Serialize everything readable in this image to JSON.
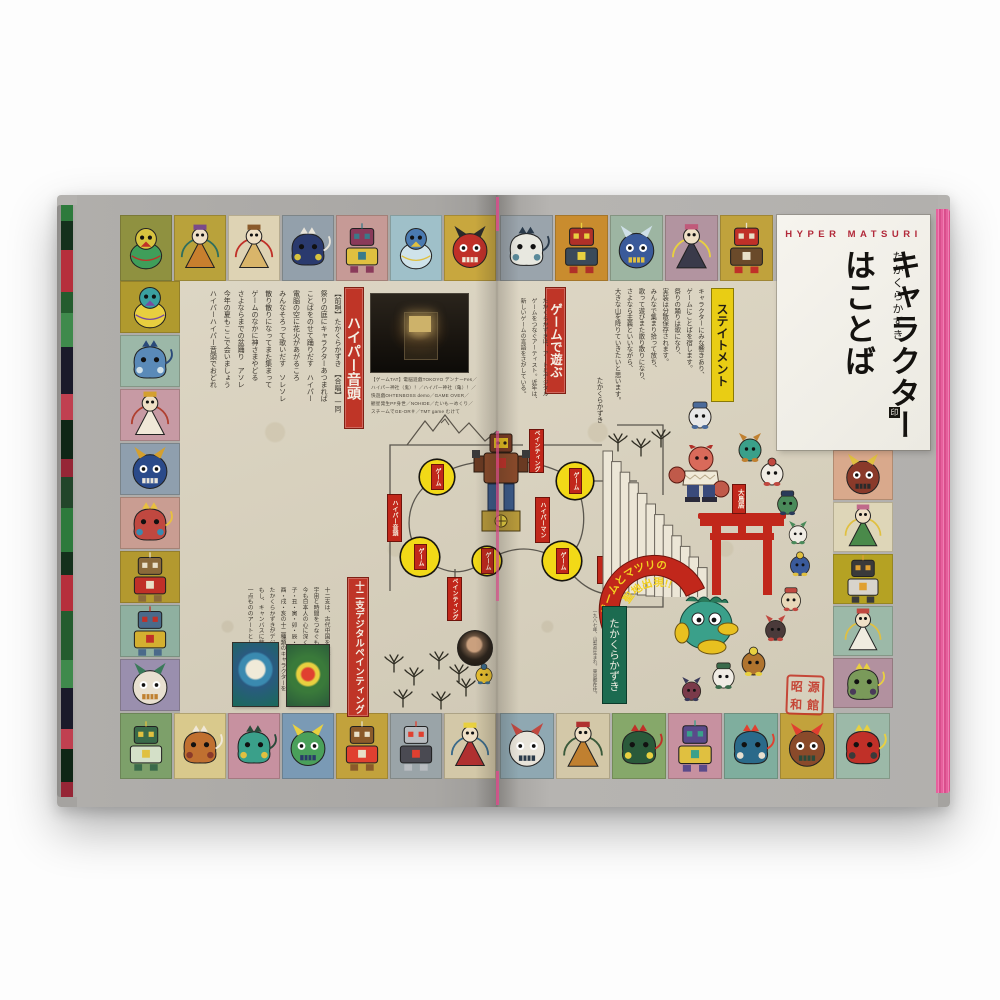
{
  "panel": {
    "kicker": "HYPER MATSURI",
    "author": "たかくらかずき",
    "title": "キャラクターはことば",
    "author_mark": "印"
  },
  "banners": {
    "hyper_ondo": "ハイパー音頭",
    "zodiac": "十二支デジタルペインティング",
    "game_asobi": "ゲームで遊ぶ",
    "statement": "ステイトメント",
    "torii_tag": "大鳥居",
    "arc_line1": "ゲームとマツリの",
    "arc_line2": "聖地出現!!",
    "author_box": "たかくらかずき"
  },
  "statement": {
    "columns": [
      "キャラクターにみな響きあり、",
      "ゲームにことばを宿します。",
      "祭りの踊りは歌になり、",
      "実装は分散保存されます。",
      "みんなで集まり拾って放ち、",
      "歌って遊びまた散り散りになり、",
      "さよなら主義といいながら、",
      "大きな山を降りていきたいと思います。"
    ],
    "signature": "たかくらかずき"
  },
  "lyrics": {
    "columns": [
      "【前唄】たかくらかずき　【合唱】一同",
      "祭りの庭にキャラクターあつまれば",
      "ことばをのせて踊りだす　ハイパー",
      "電脳の空に花火があがるころ",
      "みんなそろって歌いだす　ソレソレ",
      "散り散りになってまた集まって",
      "ゲームのなかに神さまやどる",
      "さよならまでの盆踊り　アソレ",
      "今年の夏もここで会いましょう",
      "ハイパーハイパー音頭でおどれ"
    ]
  },
  "zodiac_text": {
    "columns": [
      "十二支は、古代中国を発祥とするもので、",
      "宇宙と時間をつなぐものとして、",
      "今も日本人の心に深く根ざしています。",
      "子・丑・寅・卯・辰・巳・午・未・申・",
      "酉・戌・亥の十二種類のキャラクターを",
      "たかくらかずきがデジタルで描きます。",
      "もし、キャンバスに飾るとしたら、",
      "一点もののアートとして仕上げました。"
    ]
  },
  "intro_text": {
    "columns": [
      "たかくらかずきは、アートとデジタル",
      "ゲームをつなぐアーティスト。近年は、",
      "新しいゲームの言語をさがしている。"
    ]
  },
  "photo_caption": {
    "lines": [
      "【ゲームTAT】電脳遊戯TOKOYO デンナーFes／",
      "ハイパー神社（鬼）！／ハイパー神社（亀）！／",
      "快遊戯OHTENBOSS demo／GAME OVER／",
      "観星発生PF身世／NOHIDE／たいもーめくり／",
      "スチームでGE-OR＃／TMT game むけて"
    ]
  },
  "profile": "一九八七年、山梨県生まれ。東京都在住。",
  "seal": {
    "chars": [
      "昭",
      "和",
      "源",
      "館"
    ]
  },
  "board": {
    "node_label": "ゲーム",
    "nodes": [
      {
        "x": 380,
        "y": 282,
        "r": 17
      },
      {
        "x": 518,
        "y": 286,
        "r": 18
      },
      {
        "x": 363,
        "y": 362,
        "r": 19
      },
      {
        "x": 430,
        "y": 366,
        "r": 14
      },
      {
        "x": 505,
        "y": 366,
        "r": 19
      }
    ],
    "tags": [
      {
        "text": "ペインティング",
        "x": 473,
        "y": 235,
        "h": 42
      },
      {
        "text": "ハイパーマン",
        "x": 479,
        "y": 303,
        "h": 44
      },
      {
        "text": "ハイパー音頭",
        "x": 331,
        "y": 300,
        "h": 46
      },
      {
        "text": "ペインティング",
        "x": 391,
        "y": 383,
        "h": 42
      },
      {
        "text": "ゲーム",
        "x": 541,
        "y": 362,
        "h": 26
      }
    ]
  },
  "border_tiles": {
    "top_left": [
      {
        "bg": "#8f9140",
        "c1": "#3f9e5a",
        "c2": "#d7c33f",
        "c3": "#c03028",
        "type": "bird",
        "name": "green-parrot"
      },
      {
        "bg": "#b9a23b",
        "c1": "#c87f2e",
        "c2": "#7a4a8a",
        "c3": "#2e6e5e",
        "type": "deity",
        "name": "lotus-deity"
      },
      {
        "bg": "#ded3b4",
        "c1": "#d9b56a",
        "c2": "#8a5a2a",
        "c3": "#c03028",
        "type": "deity",
        "name": "fox-priest"
      },
      {
        "bg": "#93a0ab",
        "c1": "#2a3a6e",
        "c2": "#d7c33f",
        "c3": "#e8e4da",
        "type": "beast",
        "name": "tiger-ghost"
      },
      {
        "bg": "#c69a96",
        "c1": "#8a3a5a",
        "c2": "#e0c040",
        "c3": "#3a7a8a",
        "type": "robot",
        "name": "drummer-robot"
      },
      {
        "bg": "#9fc0c9",
        "c1": "#cfe3ea",
        "c2": "#4a7ab0",
        "c3": "#e0c040",
        "type": "bird",
        "name": "winged-angel"
      },
      {
        "bg": "#c8a73e",
        "c1": "#c03028",
        "c2": "#2a2a2a",
        "c3": "#f0e8d8",
        "type": "oni",
        "name": "red-oni"
      }
    ],
    "left": [
      {
        "bg": "#b09a2e",
        "c1": "#e8cf3f",
        "c2": "#3aa0a0",
        "c3": "#7a4aa0",
        "type": "bird",
        "name": "duck-spirit"
      },
      {
        "bg": "#9cb8a8",
        "c1": "#5a8ab8",
        "c2": "#cfe0e8",
        "c3": "#2a4a7a",
        "type": "beast",
        "name": "cloud-beast"
      },
      {
        "bg": "#c79aa4",
        "c1": "#f0e8d8",
        "c2": "#d4a030",
        "c3": "#b04030",
        "type": "deity",
        "name": "lotus-guardian"
      },
      {
        "bg": "#8f9fae",
        "c1": "#2a4a8a",
        "c2": "#d4a030",
        "c3": "#e8e4da",
        "type": "oni",
        "name": "blue-demon"
      },
      {
        "bg": "#c99d92",
        "c1": "#c04840",
        "c2": "#3a8ab0",
        "c3": "#e8c040",
        "type": "beast",
        "name": "octopus-spirit"
      },
      {
        "bg": "#b3992f",
        "c1": "#8a6a3a",
        "c2": "#c03028",
        "c3": "#e8e0c8",
        "type": "robot",
        "name": "ox-machine"
      },
      {
        "bg": "#8fb0a0",
        "c1": "#4a6a8a",
        "c2": "#d4b030",
        "c3": "#c03028",
        "type": "robot",
        "name": "teal-mecha"
      },
      {
        "bg": "#9a8fae",
        "c1": "#e8e0d0",
        "c2": "#3a7a5a",
        "c3": "#c08030",
        "type": "oni",
        "name": "envelope-cat"
      }
    ],
    "bottom_left": [
      {
        "bg": "#7da06a",
        "c1": "#3a6a4a",
        "c2": "#d4e0c8",
        "c3": "#e0c040",
        "type": "robot",
        "name": "grid-golem"
      },
      {
        "bg": "#d9c98c",
        "c1": "#c07030",
        "c2": "#8a3a2a",
        "c3": "#f0e8d8",
        "type": "beast",
        "name": "orange-crab"
      },
      {
        "bg": "#c791a0",
        "c1": "#3aa08a",
        "c2": "#e0c040",
        "c3": "#2a4a3a",
        "type": "beast",
        "name": "teal-dragon"
      },
      {
        "bg": "#7a9ab5",
        "c1": "#4aa05a",
        "c2": "#e8d040",
        "c3": "#2a3a6a",
        "type": "oni",
        "name": "frog-king"
      },
      {
        "bg": "#c2a23c",
        "c1": "#8a5a2a",
        "c2": "#e04030",
        "c3": "#e8e0c8",
        "type": "robot",
        "name": "gold-robot"
      },
      {
        "bg": "#9aa4a8",
        "c1": "#b8bcc0",
        "c2": "#4a4a52",
        "c3": "#e04030",
        "type": "robot",
        "name": "silver-mecha"
      },
      {
        "bg": "#d3c8a8",
        "c1": "#b03030",
        "c2": "#e8d040",
        "c3": "#3a6a8a",
        "type": "deity",
        "name": "shrine-keeper"
      }
    ],
    "top_right": [
      {
        "bg": "#9aa4ac",
        "c1": "#e8e8e0",
        "c2": "#5a8a9a",
        "c3": "#2a3a4a",
        "type": "beast",
        "name": "wave-beast"
      },
      {
        "bg": "#c98c2e",
        "c1": "#b03028",
        "c2": "#3a4a5a",
        "c3": "#e8d040",
        "type": "robot",
        "name": "samurai-helm"
      },
      {
        "bg": "#9db5a2",
        "c1": "#3a5a9a",
        "c2": "#cfe0e8",
        "c3": "#e0c040",
        "type": "oni",
        "name": "blue-round-spirit"
      },
      {
        "bg": "#b294a0",
        "c1": "#3a3a4a",
        "c2": "#c05a7a",
        "c3": "#e8d040",
        "type": "deity",
        "name": "dark-samurai"
      },
      {
        "bg": "#c0a23c",
        "c1": "#c03028",
        "c2": "#6a4a2a",
        "c3": "#e8e0c8",
        "type": "robot",
        "name": "tv-face-robot"
      }
    ],
    "right": [
      {
        "bg": "#d9a98c",
        "c1": "#8a3a2a",
        "c2": "#e0c040",
        "c3": "#2a2a2a",
        "type": "oni",
        "name": "horned-samurai"
      },
      {
        "bg": "#ded6b8",
        "c1": "#4a8a4a",
        "c2": "#c06a8a",
        "c3": "#e0c040",
        "type": "deity",
        "name": "green-deity"
      },
      {
        "bg": "#b5a223",
        "c1": "#3a3a3a",
        "c2": "#d8d4cc",
        "c3": "#e0a030",
        "type": "robot",
        "name": "press-machine"
      },
      {
        "bg": "#9cb9a8",
        "c1": "#f0ece0",
        "c2": "#c04840",
        "c3": "#e0c040",
        "type": "deity",
        "name": "lute-player"
      },
      {
        "bg": "#b2919f",
        "c1": "#7a9a5a",
        "c2": "#4a3a5a",
        "c3": "#e8d040",
        "type": "beast",
        "name": "gourd-creature"
      }
    ],
    "bottom_right": [
      {
        "bg": "#8fa8b2",
        "c1": "#e8e4da",
        "c2": "#c04840",
        "c3": "#2a3a4a",
        "type": "oni",
        "name": "rabbit-drummer"
      },
      {
        "bg": "#d3c8a8",
        "c1": "#c08030",
        "c2": "#b03030",
        "c3": "#3a5a3a",
        "type": "deity",
        "name": "lantern-twins"
      },
      {
        "bg": "#86a86a",
        "c1": "#2a5a3a",
        "c2": "#e8d040",
        "c3": "#c03028",
        "type": "beast",
        "name": "forest-spirit"
      },
      {
        "bg": "#c791a0",
        "c1": "#5a4a8a",
        "c2": "#e0c040",
        "c3": "#3aa08a",
        "type": "robot",
        "name": "violet-robot"
      },
      {
        "bg": "#7fae9e",
        "c1": "#2a6a8a",
        "c2": "#e8e0d0",
        "c3": "#e04030",
        "type": "beast",
        "name": "teal-fish"
      },
      {
        "bg": "#c2a23c",
        "c1": "#8a4a2a",
        "c2": "#e04030",
        "c3": "#2a4a3a",
        "type": "oni",
        "name": "dragon-mask"
      },
      {
        "bg": "#9cb9a8",
        "c1": "#c03028",
        "c2": "#3a3a3a",
        "c3": "#e8d040",
        "type": "beast",
        "name": "red-eye-totem"
      }
    ]
  },
  "sprites": [
    {
      "x": 628,
      "y": 205,
      "s": 30,
      "c1": "#e8e8e8",
      "c2": "#4a6a9a",
      "name": "mouse-monk"
    },
    {
      "x": 678,
      "y": 238,
      "s": 30,
      "c1": "#3aa08a",
      "c2": "#c08030",
      "name": "turtle-robot"
    },
    {
      "x": 700,
      "y": 262,
      "s": 30,
      "c1": "#f0ece4",
      "c2": "#c04840",
      "name": "rabbit-dancer"
    },
    {
      "x": 717,
      "y": 294,
      "s": 27,
      "c1": "#4a8a5a",
      "c2": "#2a3a5a",
      "name": "green-demon"
    },
    {
      "x": 729,
      "y": 326,
      "s": 24,
      "c1": "#f0ece4",
      "c2": "#4a8a5a",
      "name": "round-sage"
    },
    {
      "x": 730,
      "y": 356,
      "s": 26,
      "c1": "#3a5a9a",
      "c2": "#e0c040",
      "name": "samurai-chief"
    },
    {
      "x": 721,
      "y": 391,
      "s": 26,
      "c1": "#e8d8b8",
      "c2": "#c04840",
      "name": "sheep-priest"
    },
    {
      "x": 705,
      "y": 420,
      "s": 27,
      "c1": "#4a3a3a",
      "c2": "#c04840",
      "name": "cart-beast"
    },
    {
      "x": 681,
      "y": 451,
      "s": 31,
      "c1": "#b0742e",
      "c2": "#e8d040",
      "name": "lion-guard"
    },
    {
      "x": 652,
      "y": 466,
      "s": 29,
      "c1": "#f0ece4",
      "c2": "#3a6a4a",
      "name": "panda-dog"
    },
    {
      "x": 622,
      "y": 482,
      "s": 25,
      "c1": "#7a3a4a",
      "c2": "#3a3a5a",
      "name": "little-imp"
    },
    {
      "x": 416,
      "y": 468,
      "s": 22,
      "c1": "#e8c030",
      "c2": "#3a6a8a",
      "name": "small-sprite"
    }
  ],
  "pines": [
    {
      "x": 326,
      "y": 458
    },
    {
      "x": 346,
      "y": 471
    },
    {
      "x": 371,
      "y": 455
    },
    {
      "x": 391,
      "y": 468
    },
    {
      "x": 335,
      "y": 493
    },
    {
      "x": 373,
      "y": 495
    },
    {
      "x": 398,
      "y": 482
    },
    {
      "x": 550,
      "y": 237
    },
    {
      "x": 573,
      "y": 242
    },
    {
      "x": 593,
      "y": 233
    }
  ],
  "fore_edge_colors": [
    "#2d7a3c",
    "#14301c",
    "#b62f3c",
    "#245c2e",
    "#3f8a4c",
    "#1a1a2a",
    "#c04050",
    "#0f2616",
    "#962636",
    "#22452a"
  ]
}
